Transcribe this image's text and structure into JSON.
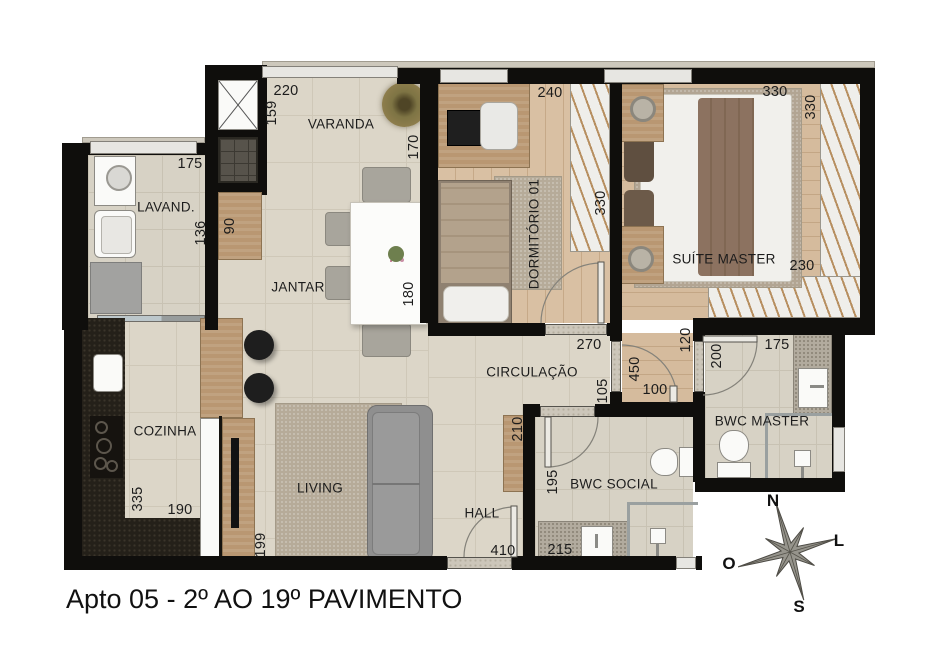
{
  "title": "Apto 05 - 2º AO 19º PAVIMENTO",
  "compass": {
    "north": "N",
    "east": "L",
    "west": "O",
    "south": "S"
  },
  "rooms": {
    "varanda": "VARANDA",
    "lavanderia": "LAVAND.",
    "jantar": "JANTAR",
    "dormitorio": "DORMITÓRIO 01",
    "suite": "SUÍTE MASTER",
    "circulacao": "CIRCULAÇÃO",
    "cozinha": "COZINHA",
    "living": "LIVING",
    "hall": "HALL",
    "bwc_social": "BWC SOCIAL",
    "bwc_master": "BWC MASTER"
  },
  "dims": {
    "varanda_width": "220",
    "varanda_depth": "159",
    "varanda_depth_right": "170",
    "lavand_width": "175",
    "lavand_depth": "136",
    "hall_cabinet": "90",
    "table_length": "180",
    "dorm_width": "240",
    "dorm_length": "330",
    "dorm_door": "270",
    "suite_width": "330",
    "suite_length": "330",
    "suite_closet": "230",
    "suite_door": "120",
    "suite_hall_length": "450",
    "suite_hall_width": "100",
    "circ_width": "105",
    "sideboard_length": "210",
    "bwcm_length": "200",
    "bwcm_width": "175",
    "kitchen_length": "335",
    "kitchen_width": "190",
    "tv_panel": "199",
    "hall_width": "410",
    "bwcs_length": "195",
    "bwcs_width": "215"
  },
  "palette": {
    "wall": "#0f0e0c",
    "floor_tile": "#dcd6c8",
    "floor_wood": "#d9c0a3",
    "bath_tile": "#d7d2c5",
    "counter_dark": "#242019",
    "counter_stone": "#b2ab9e",
    "wood_furniture": "#b99772",
    "sofa": "#8f8f8f",
    "rug": "#b6ab99",
    "window": "#e7e6e2",
    "text": "#1c1c1c"
  }
}
